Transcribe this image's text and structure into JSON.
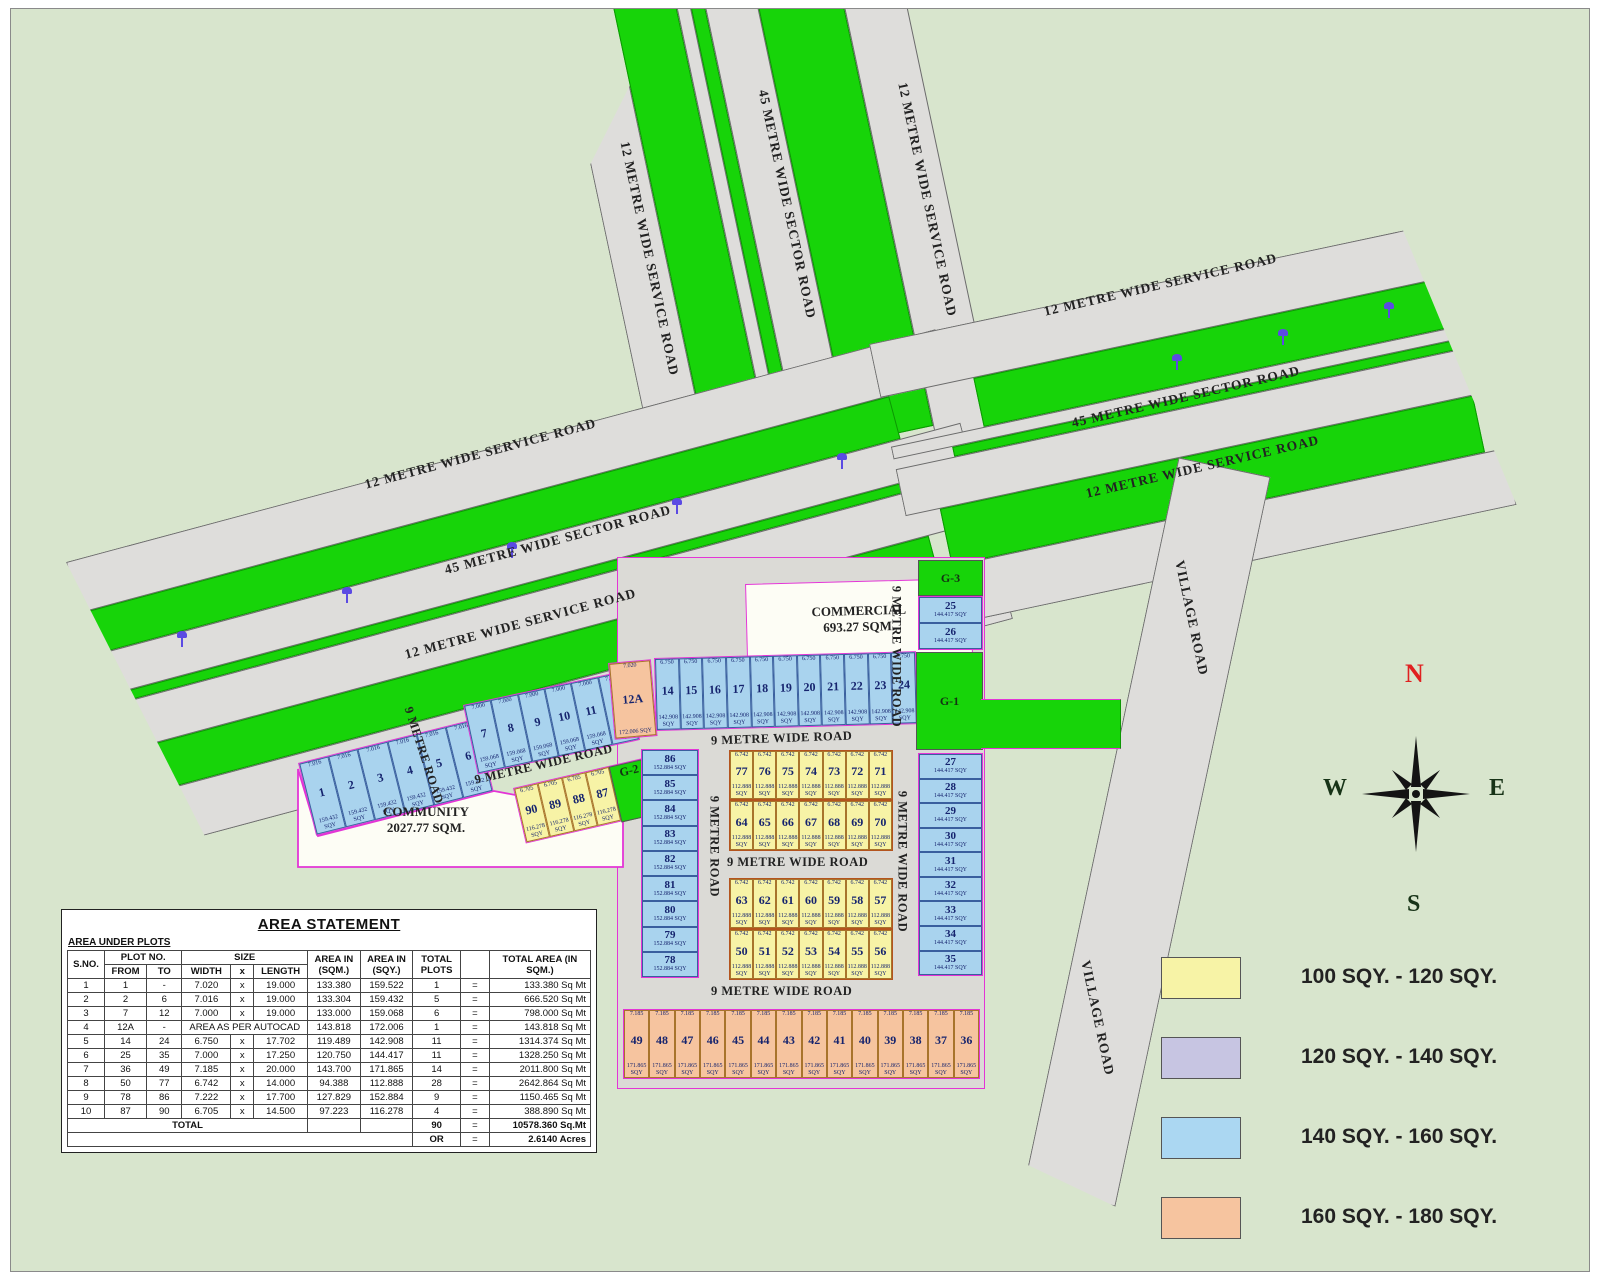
{
  "map": {
    "roads": {
      "service_12m": "12 METRE WIDE SERVICE ROAD",
      "sector_45m": "45 METRE WIDE SECTOR ROAD",
      "nine_wide": "9 METRE WIDE ROAD",
      "nine": "9 METRE ROAD",
      "village": "VILLAGE ROAD"
    },
    "areas": {
      "commercial_title": "COMMERCIAL",
      "commercial_area": "693.27 SQM.",
      "community_title": "COMMUNITY",
      "community_area": "2027.77 SQM.",
      "g1": "G-1",
      "g2": "G-2",
      "g3": "G-3"
    },
    "compass": {
      "north": "N",
      "south": "S",
      "east": "E",
      "west": "W"
    }
  },
  "plot_groups": {
    "g_1_6": {
      "color": "blue",
      "dim": "7.016",
      "area": "159.432 SQY",
      "cells": [
        "1",
        "2",
        "3",
        "4",
        "5",
        "6"
      ]
    },
    "g_7_12": {
      "color": "blue",
      "dim": "7.000",
      "area": "159.068 SQY",
      "cells": [
        "7",
        "8",
        "9",
        "10",
        "11",
        "12"
      ]
    },
    "g_12a": {
      "color": "peach",
      "dim": "7.020",
      "area": "172.006 SQY",
      "cells": [
        "12A"
      ]
    },
    "g_14_24": {
      "color": "blue",
      "dim": "6.750",
      "area": "142.908 SQY",
      "cells": [
        "14",
        "15",
        "16",
        "17",
        "18",
        "19",
        "20",
        "21",
        "22",
        "23",
        "24"
      ]
    },
    "g_25_26": {
      "color": "blue",
      "dim": "7.000",
      "area": "144.417 SQY",
      "cells": [
        "25",
        "26"
      ]
    },
    "g_27_35": {
      "color": "blue",
      "dim": "7.000",
      "area": "144.417 SQY",
      "cells": [
        "27",
        "28",
        "29",
        "30",
        "31",
        "32",
        "33",
        "34",
        "35"
      ]
    },
    "g_86_78": {
      "color": "blue",
      "dim": "7.222",
      "area": "152.884 SQY",
      "cells": [
        "86",
        "85",
        "84",
        "83",
        "82",
        "81",
        "80",
        "79",
        "78"
      ]
    },
    "g_77_71": {
      "color": "yellow",
      "dim": "6.742",
      "area": "112.888 SQY",
      "cells": [
        "77",
        "76",
        "75",
        "74",
        "73",
        "72",
        "71"
      ]
    },
    "g_64_70": {
      "color": "yellow",
      "dim": "6.742",
      "area": "112.888 SQY",
      "cells": [
        "64",
        "65",
        "66",
        "67",
        "68",
        "69",
        "70"
      ]
    },
    "g_63_57": {
      "color": "yellow",
      "dim": "6.742",
      "area": "112.888 SQY",
      "cells": [
        "63",
        "62",
        "61",
        "60",
        "59",
        "58",
        "57"
      ]
    },
    "g_50_56": {
      "color": "yellow",
      "dim": "6.742",
      "area": "112.888 SQY",
      "cells": [
        "50",
        "51",
        "52",
        "53",
        "54",
        "55",
        "56"
      ]
    },
    "g_90_87": {
      "color": "yellow",
      "dim": "6.705",
      "area": "116.278 SQY",
      "cells": [
        "90",
        "89",
        "88",
        "87"
      ]
    },
    "g_49_36": {
      "color": "peach",
      "dim": "7.185",
      "area": "171.865 SQY",
      "cells": [
        "49",
        "48",
        "47",
        "46",
        "45",
        "44",
        "43",
        "42",
        "41",
        "40",
        "39",
        "38",
        "37",
        "36"
      ]
    }
  },
  "legend": {
    "items": [
      {
        "color": "#f7f3a6",
        "label": "100 SQY. - 120 SQY."
      },
      {
        "color": "#c7c5e2",
        "label": "120 SQY. - 140 SQY."
      },
      {
        "color": "#abd7f2",
        "label": "140 SQY. - 160 SQY."
      },
      {
        "color": "#f6c49f",
        "label": "160 SQY. - 180 SQY."
      }
    ]
  },
  "table": {
    "title": "AREA STATEMENT",
    "subtitle": "AREA UNDER PLOTS",
    "headers": {
      "sno": "S.NO.",
      "plot_no": "PLOT  NO.",
      "from": "FROM",
      "to": "TO",
      "size": "SIZE",
      "width": "WIDTH",
      "x": "x",
      "length": "LENGTH",
      "area_sqm": "AREA IN\n(SQM.)",
      "area_sqy": "AREA IN\n(SQY.)",
      "total_plots": "TOTAL\nPLOTS",
      "total_area": "TOTAL AREA (IN SQM.)"
    },
    "rows": [
      [
        "1",
        "1",
        "-",
        "7.020",
        "x",
        "19.000",
        "133.380",
        "159.522",
        "1",
        "=",
        "133.380 Sq Mt"
      ],
      [
        "2",
        "2",
        "6",
        "7.016",
        "x",
        "19.000",
        "133.304",
        "159.432",
        "5",
        "=",
        "666.520 Sq Mt"
      ],
      [
        "3",
        "7",
        "12",
        "7.000",
        "x",
        "19.000",
        "133.000",
        "159.068",
        "6",
        "=",
        "798.000 Sq Mt"
      ],
      [
        "4",
        "12A",
        "-",
        "AREA AS PER AUTOCAD",
        "",
        "",
        "143.818",
        "172.006",
        "1",
        "=",
        "143.818 Sq Mt"
      ],
      [
        "5",
        "14",
        "24",
        "6.750",
        "x",
        "17.702",
        "119.489",
        "142.908",
        "11",
        "=",
        "1314.374 Sq Mt"
      ],
      [
        "6",
        "25",
        "35",
        "7.000",
        "x",
        "17.250",
        "120.750",
        "144.417",
        "11",
        "=",
        "1328.250 Sq Mt"
      ],
      [
        "7",
        "36",
        "49",
        "7.185",
        "x",
        "20.000",
        "143.700",
        "171.865",
        "14",
        "=",
        "2011.800 Sq Mt"
      ],
      [
        "8",
        "50",
        "77",
        "6.742",
        "x",
        "14.000",
        "94.388",
        "112.888",
        "28",
        "=",
        "2642.864 Sq Mt"
      ],
      [
        "9",
        "78",
        "86",
        "7.222",
        "x",
        "17.700",
        "127.829",
        "152.884",
        "9",
        "=",
        "1150.465 Sq Mt"
      ],
      [
        "10",
        "87",
        "90",
        "6.705",
        "x",
        "14.500",
        "97.223",
        "116.278",
        "4",
        "=",
        "388.890 Sq Mt"
      ]
    ],
    "total_row": {
      "label": "TOTAL",
      "plots": "90",
      "eq": "=",
      "value": "10578.360 Sq.Mt"
    },
    "or_row": {
      "label": "OR",
      "eq": "=",
      "value": "2.6140 Acres"
    }
  }
}
